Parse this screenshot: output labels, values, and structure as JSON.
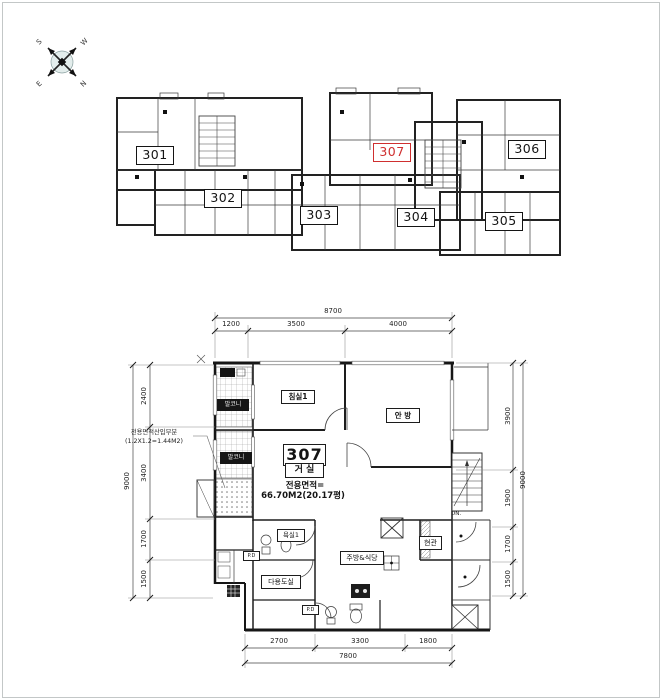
{
  "compass": {
    "nw": "S",
    "ne": "W",
    "sw": "E",
    "se": "N"
  },
  "overview": {
    "units": [
      {
        "label": "301"
      },
      {
        "label": "302"
      },
      {
        "label": "303"
      },
      {
        "label": "304"
      },
      {
        "label": "305"
      },
      {
        "label": "306"
      },
      {
        "label": "307",
        "highlight": true
      }
    ]
  },
  "detail": {
    "unit": {
      "number": "307",
      "room": "거 실",
      "area_label": "전용면적=",
      "area_value": "66.70M2(20.17평)"
    },
    "rooms": {
      "bedroom1": "침실1",
      "master": "안 방",
      "balcony1": "발코니",
      "balcony2": "발코니",
      "bath1": "욕실1",
      "utility": "다용도실",
      "kitchen": "주방&식당",
      "entry": "현관"
    },
    "stairs_label": "DN.",
    "pd_label": "P.D",
    "annotation": {
      "line1": "전용면적산입부분",
      "line2": "(1.2X1.2=1.44M2)"
    },
    "dims": {
      "top": {
        "total": "8700",
        "segments": [
          "1200",
          "3500",
          "4000"
        ]
      },
      "bottom": {
        "total": "7800",
        "segments": [
          "2700",
          "3300",
          "1800"
        ]
      },
      "left": {
        "total": "9000",
        "segments": [
          "2400",
          "3400",
          "1700",
          "1500"
        ]
      },
      "right": {
        "total": "9000",
        "segments": [
          "3900",
          "1900",
          "1700",
          "1500"
        ]
      }
    }
  }
}
